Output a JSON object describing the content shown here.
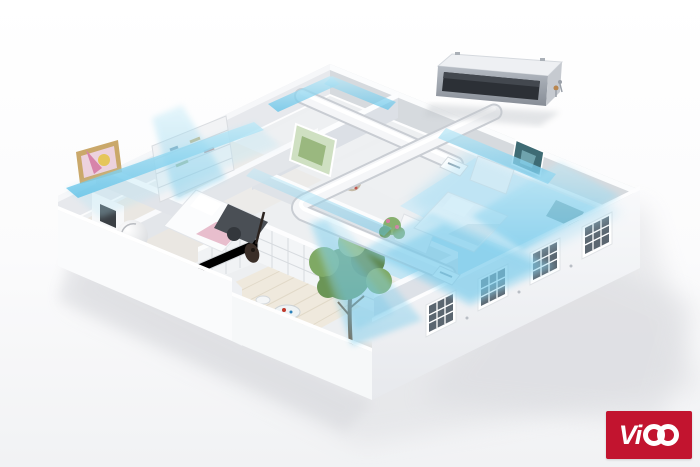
{
  "brand": {
    "logo_text": "Vico",
    "logo_text_prefix": "Vi",
    "logo_bg_color": "#c2142f",
    "logo_text_color": "#ffffff"
  },
  "scene": {
    "type": "3d-apartment-cutaway",
    "description": "Isometric 3D cutaway of an apartment showing a concealed ducted air conditioner on the roof distributing cool blue airflow through white ceiling ducts into every room",
    "colors": {
      "background_top": "#ffffff",
      "background_bottom": "#f1f2f4",
      "airflow": "#7fcdea",
      "walls": "#f7f8fa",
      "wall_shadow": "#d8dce1",
      "duct": "#f5f6f8",
      "ac_unit_body": "#a9afb7",
      "ac_unit_grille": "#2c3036",
      "window_pane": "#5b6670",
      "deck_wood": "#efe9dd",
      "foliage": "#6b9556",
      "ground_shadow": "#d8d9dd"
    },
    "elements": [
      "ac-indoor-unit",
      "supply-duct",
      "duct-vent",
      "airflow-stream",
      "living-room-fireplace",
      "living-room-painting",
      "ball-chair",
      "bookshelf",
      "bed",
      "desk",
      "wardrobe",
      "wall-picture",
      "wreath",
      "guitar",
      "potted-plant",
      "balcony-deck",
      "garden-table",
      "tree",
      "french-door-lattice",
      "paned-windows"
    ]
  }
}
